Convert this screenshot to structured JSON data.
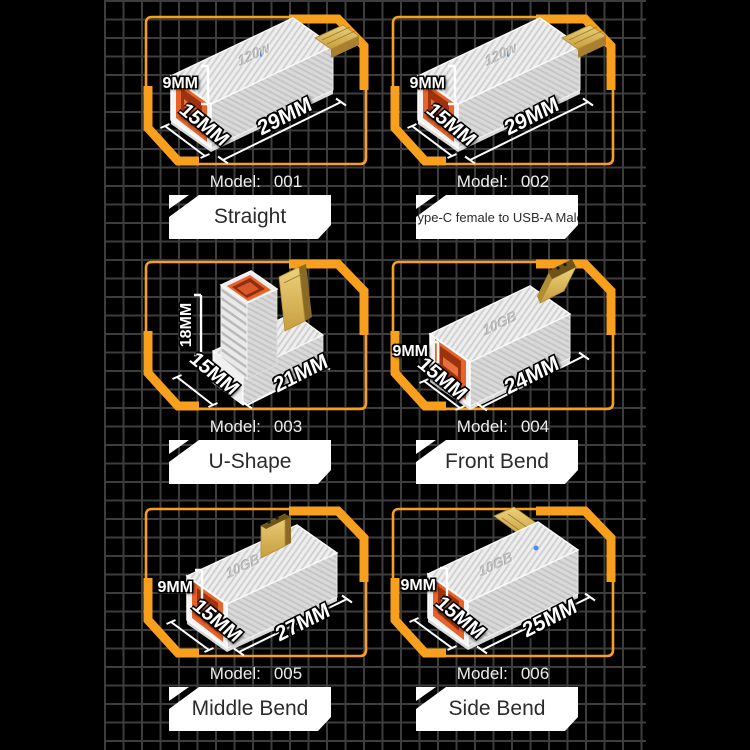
{
  "colors": {
    "background": "#000000",
    "grid_line": "#3d3d3d",
    "frame_accent": "#F8A01D",
    "plate_background": "#FFFFFF",
    "plate_text": "#2B2B2B",
    "dimension_text": "#FFFFFF",
    "port_orange": "#E8632A",
    "connector_gold": "#D9B356",
    "led_blue": "#4A8CF5",
    "body_gray": "#EDEDED"
  },
  "panels": [
    {
      "model_label": "Model:",
      "model_number": "001",
      "tag": "Straight",
      "device_text": "120w",
      "shape": "straight",
      "dims": {
        "height": "9MM",
        "width": "15MM",
        "length": "29MM"
      }
    },
    {
      "model_label": "Model:",
      "model_number": "002",
      "tag": "Type-C female to USB-A Male",
      "device_text": "120w",
      "shape": "straight",
      "dims": {
        "height": "9MM",
        "width": "15MM",
        "length": "29MM"
      }
    },
    {
      "model_label": "Model:",
      "model_number": "003",
      "tag": "U-Shape",
      "device_text": "",
      "shape": "u-shape",
      "dims": {
        "height": "18MM",
        "width": "15MM",
        "length": "21MM"
      }
    },
    {
      "model_label": "Model:",
      "model_number": "004",
      "tag": "Front Bend",
      "device_text": "10GB",
      "shape": "front-bend",
      "dims": {
        "height": "9MM",
        "width": "15MM",
        "length": "24MM"
      }
    },
    {
      "model_label": "Model:",
      "model_number": "005",
      "tag": "Middle Bend",
      "device_text": "10GB",
      "shape": "middle-bend",
      "dims": {
        "height": "9MM",
        "width": "15MM",
        "length": "27MM"
      }
    },
    {
      "model_label": "Model:",
      "model_number": "006",
      "tag": "Side Bend",
      "device_text": "10GB",
      "shape": "side-bend",
      "dims": {
        "height": "9MM",
        "width": "15MM",
        "length": "25MM"
      }
    }
  ]
}
